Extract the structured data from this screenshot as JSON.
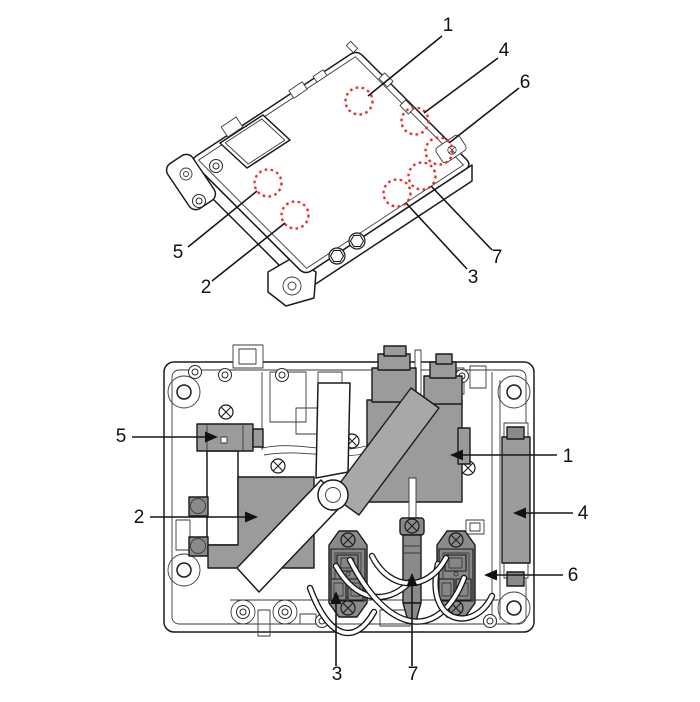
{
  "diagram": {
    "colors": {
      "marker_red": "#e8312e",
      "component_gray": "#9b9b9b",
      "component_gray_dark": "#8a8a8a",
      "band_gray": "#a8a8a8",
      "line_dark": "#1b1b1b",
      "background": "#ffffff"
    },
    "isometric_view": {
      "callouts": [
        "1",
        "2",
        "3",
        "4",
        "5",
        "6",
        "7"
      ]
    },
    "top_view": {
      "callouts": [
        "1",
        "2",
        "3",
        "4",
        "5",
        "6",
        "7"
      ]
    }
  }
}
